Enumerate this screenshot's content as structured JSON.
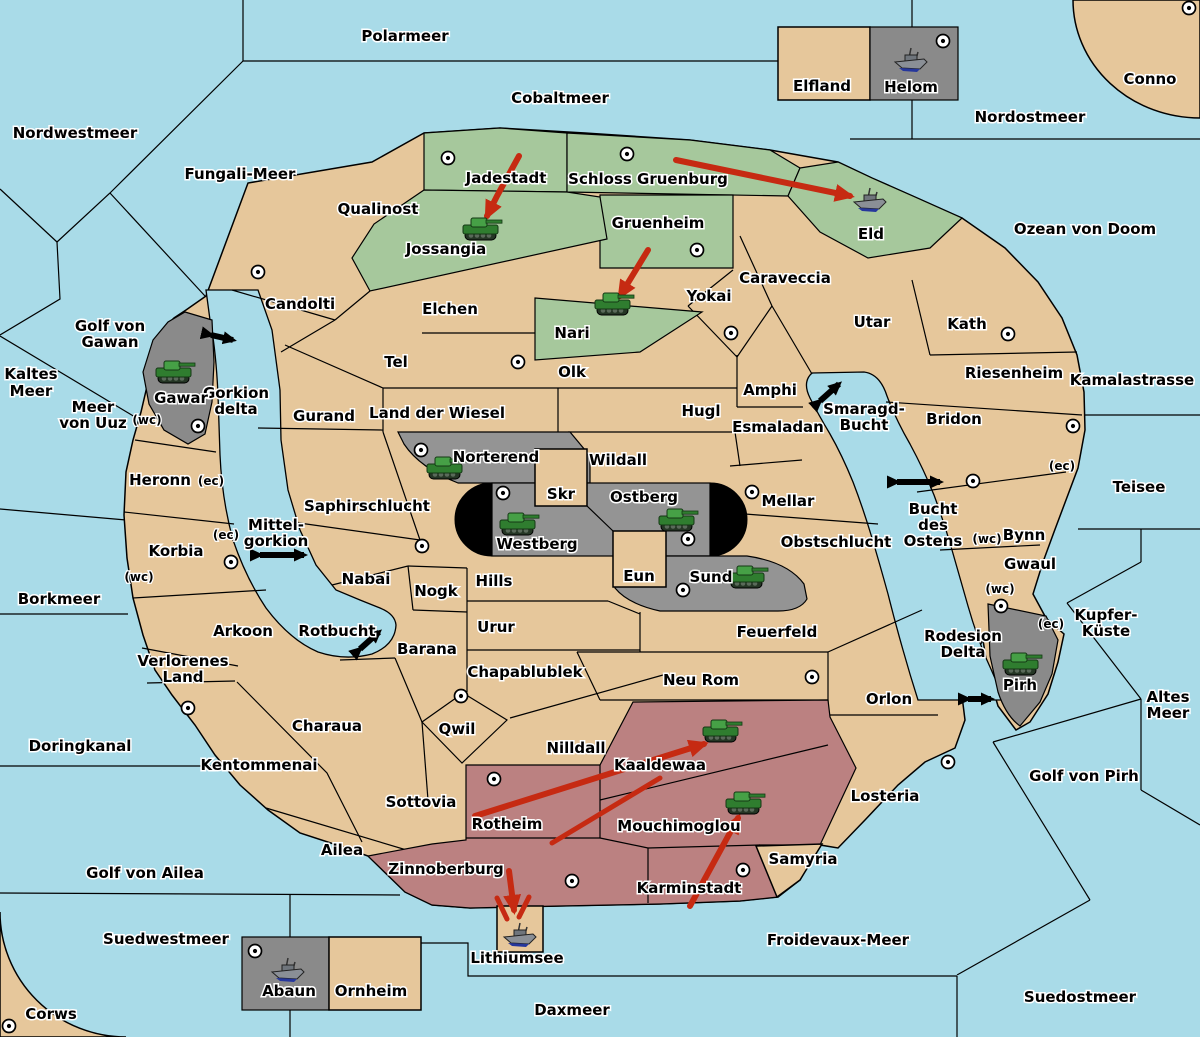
{
  "colors": {
    "sea": "#A9DBE8",
    "land_tan": "#E6C79B",
    "player_green": "#A6C89C",
    "player_gray": "#949494",
    "player_maroon": "#BB8181",
    "attack_arrow_red": "#C62A12",
    "link_arrow_black": "#000000"
  },
  "labels": {
    "sea": {
      "polarmeer": "Polarmeer",
      "cobaltmeer": "Cobaltmeer",
      "nordostmeer": "Nordostmeer",
      "conno": "Conno",
      "nordwestmeer": "Nordwestmeer",
      "fungali_meer": "Fungali-Meer",
      "ozean_von_doom": "Ozean von Doom",
      "kaltes_meer_1": "Kaltes",
      "kaltes_meer_2": "Meer",
      "meer_von_uuz_1": "Meer",
      "meer_von_uuz_2": "von Uuz",
      "golf_von_gawan_1": "Golf von",
      "golf_von_gawan_2": "Gawan",
      "kamalastrasse": "Kamalastrasse",
      "teisee": "Teisee",
      "borkmeer": "Borkmeer",
      "kupfer_kueste_1": "Kupfer-",
      "kupfer_kueste_2": "Küste",
      "altes_meer_1": "Altes",
      "altes_meer_2": "Meer",
      "golf_von_pirh": "Golf von Pirh",
      "doringkanal": "Doringkanal",
      "golf_von_ailea": "Golf von Ailea",
      "suedwestmeer": "Suedwestmeer",
      "corws": "Corws",
      "daxmeer": "Daxmeer",
      "froidevaux_meer": "Froidevaux-Meer",
      "suedostmeer": "Suedostmeer",
      "gorkion_delta_1": "Gorkion",
      "gorkion_delta_2": "delta",
      "mittel_gorkion_1": "Mittel-",
      "mittel_gorkion_2": "gorkion",
      "smaragd_bucht_1": "Smaragd-",
      "smaragd_bucht_2": "Bucht",
      "bucht_des_ostens_1": "Bucht",
      "bucht_des_ostens_2": "des",
      "bucht_des_ostens_3": "Ostens",
      "rotbucht": "Rotbucht",
      "rodesion_delta_1": "Rodesion",
      "rodesion_delta_2": "Delta",
      "lithiumsee": "Lithiumsee"
    },
    "land": {
      "qualinost": "Qualinost",
      "jadestadt": "Jadestadt",
      "schloss_gruenburg": "Schloss Gruenburg",
      "elfland": "Elfland",
      "helom": "Helom",
      "jossangia": "Jossangia",
      "gruenheim": "Gruenheim",
      "eld": "Eld",
      "caraveccia": "Caraveccia",
      "candolti": "Candolti",
      "elchen": "Elchen",
      "yokai": "Yokai",
      "utar": "Utar",
      "kath": "Kath",
      "nari": "Nari",
      "tel": "Tel",
      "olk": "Olk",
      "riesenheim": "Riesenheim",
      "amphi": "Amphi",
      "hugl": "Hugl",
      "esmaladan": "Esmaladan",
      "bridon": "Bridon",
      "gurand": "Gurand",
      "land_der_wiesel": "Land der Wiesel",
      "gawar": "Gawar",
      "norterend": "Norterend",
      "wildall": "Wildall",
      "skr": "Skr",
      "ostberg": "Ostberg",
      "mellar": "Mellar",
      "bynn": "Bynn",
      "heronn": "Heronn",
      "saphirschlucht": "Saphirschlucht",
      "westberg": "Westberg",
      "obstschlucht": "Obstschlucht",
      "gwaul": "Gwaul",
      "korbia": "Korbia",
      "nabai": "Nabai",
      "hills": "Hills",
      "eun": "Eun",
      "sund": "Sund",
      "nogk": "Nogk",
      "urur": "Urur",
      "feuerfeld": "Feuerfeld",
      "pirh": "Pirh",
      "arkoon": "Arkoon",
      "barana": "Barana",
      "chapablublek": "Chapablublek",
      "neu_rom": "Neu Rom",
      "orlon": "Orlon",
      "verlorenes_land_1": "Verlorenes",
      "verlorenes_land_2": "Land",
      "charaua": "Charaua",
      "qwil": "Qwil",
      "nilldall": "Nilldall",
      "kaaldewaa": "Kaaldewaa",
      "kentommenai": "Kentommenai",
      "sottovia": "Sottovia",
      "rotheim": "Rotheim",
      "mouchimoglou": "Mouchimoglou",
      "losteria": "Losteria",
      "ailea": "Ailea",
      "zinnoberburg": "Zinnoberburg",
      "karminstadt": "Karminstadt",
      "samyria": "Samyria",
      "abaun": "Abaun",
      "ornheim": "Ornheim"
    },
    "tags": {
      "wc": "(wc)",
      "ec": "(ec)"
    }
  },
  "units": {
    "tank_locations": [
      "Jossangia",
      "Nari",
      "Gawar",
      "Norterend",
      "Westberg",
      "Ostberg",
      "Sund",
      "Kaaldewaa",
      "Mouchimoglou",
      "Pirh"
    ],
    "ship_locations": [
      "Helom",
      "Eld",
      "Abaun",
      "Lithiumsee"
    ]
  },
  "attack_arrows": [
    {
      "from": "Jadestadt",
      "to": "Jossangia"
    },
    {
      "from": "Schloss Gruenburg",
      "to": "Eld"
    },
    {
      "from": "Gruenheim",
      "to": "Nari"
    },
    {
      "from": "Rotheim",
      "to": "Kaaldewaa"
    },
    {
      "from": "Karminstadt",
      "to": "Mouchimoglou"
    },
    {
      "from": "Zinnoberburg",
      "to": "Lithiumsee"
    }
  ],
  "link_arrows": [
    "Golf von Gawan - Gorkion delta",
    "Mittel-gorkion crossing",
    "Smaragd-Bucht crossing",
    "Bucht des Ostens crossing",
    "Rodesion Delta - Pirh",
    "Rotbucht crossing"
  ]
}
